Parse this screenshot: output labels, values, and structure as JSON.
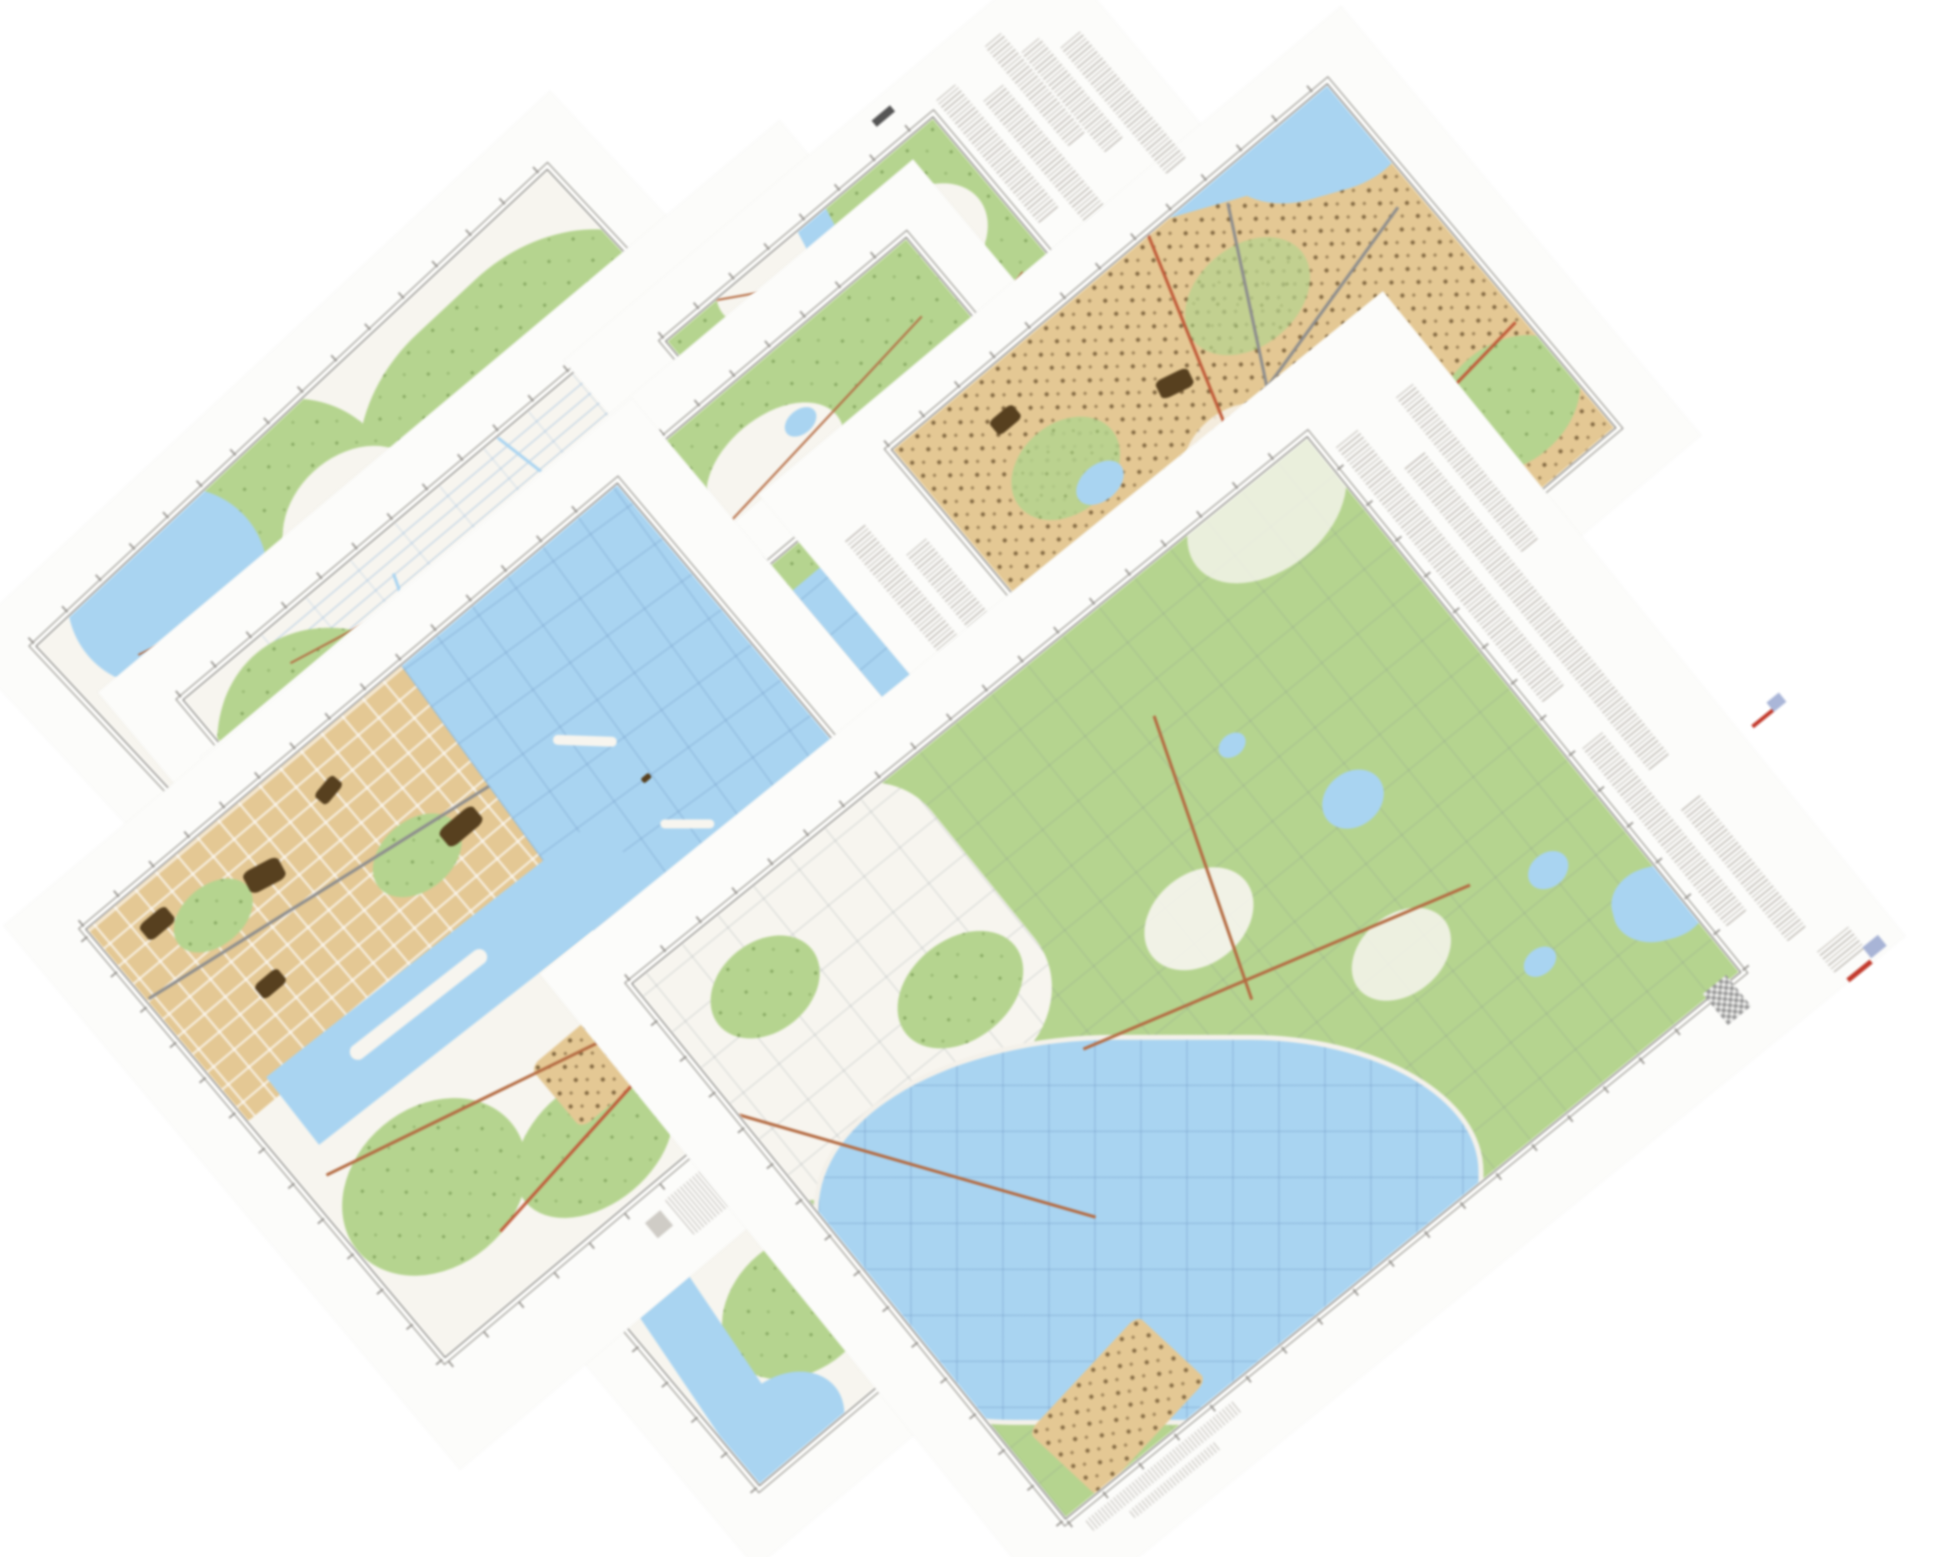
{
  "canvas": {
    "width": 1946,
    "height": 1557,
    "background": "#ffffff"
  },
  "scene": {
    "description": "Collage of seven overlapping rotated topographic map sheets on a white background; all margin lettering is illegible fine print",
    "sheet_rotation_deg": -40
  },
  "palette": {
    "paper": "#fcfcfa",
    "forest": "#b5d48f",
    "forest_dark": "#7fa85c",
    "open": "#f7f5ef",
    "water": "#a9d4f1",
    "watergrid": "#7fa9cc",
    "urban": "#e4c894",
    "urban_dark": "#57401f",
    "road": "#b46a41",
    "road_red": "#c05a39",
    "rail": "#8d8d8d",
    "neatline": "#6f6c68",
    "mtx": "#b4afa8",
    "tick": "#8a8782"
  },
  "sheets": [
    {
      "id": "sheet-a",
      "kind": "topographic sheet: forest, river and open fields (top left sliver)",
      "rotation_deg": -43
    },
    {
      "id": "sheet-b",
      "kind": "topographic sheet: drained polder grid with canals and forest (sliver)",
      "rotation_deg": -40
    },
    {
      "id": "sheet-d",
      "kind": "topographic sheet: forest with river bend and clearings (top middle)",
      "rotation_deg": -40
    },
    {
      "id": "sheet-c0",
      "kind": "topographic sheet: coastal forest band with ponds (sliver)",
      "rotation_deg": -40
    },
    {
      "id": "sheet-c",
      "kind": "topographic sheet: sea with coordinate grid and strait (centre)",
      "rotation_deg": -40
    },
    {
      "id": "sheet-e",
      "kind": "topographic sheet: city with harbour, piers and gridded river (bottom left)",
      "rotation_deg": -40
    },
    {
      "id": "sheet-f",
      "kind": "topographic sheet: dense city with railways and river (top right)",
      "rotation_deg": -40
    },
    {
      "id": "sheet-g",
      "kind": "topographic sheet: large forest with lakes, bay and village (right)",
      "rotation_deg": -39
    }
  ],
  "marginalia": {
    "note_columns": "illegible grey fine-print legend columns",
    "sheet_label": "illegible dark sheet designation",
    "qr_block": "checkered registration block",
    "color_marks": [
      "small red and blue legend mark",
      "red and blue legend mark with grey notes"
    ],
    "scale_note": "illegible scale note under south corner"
  }
}
